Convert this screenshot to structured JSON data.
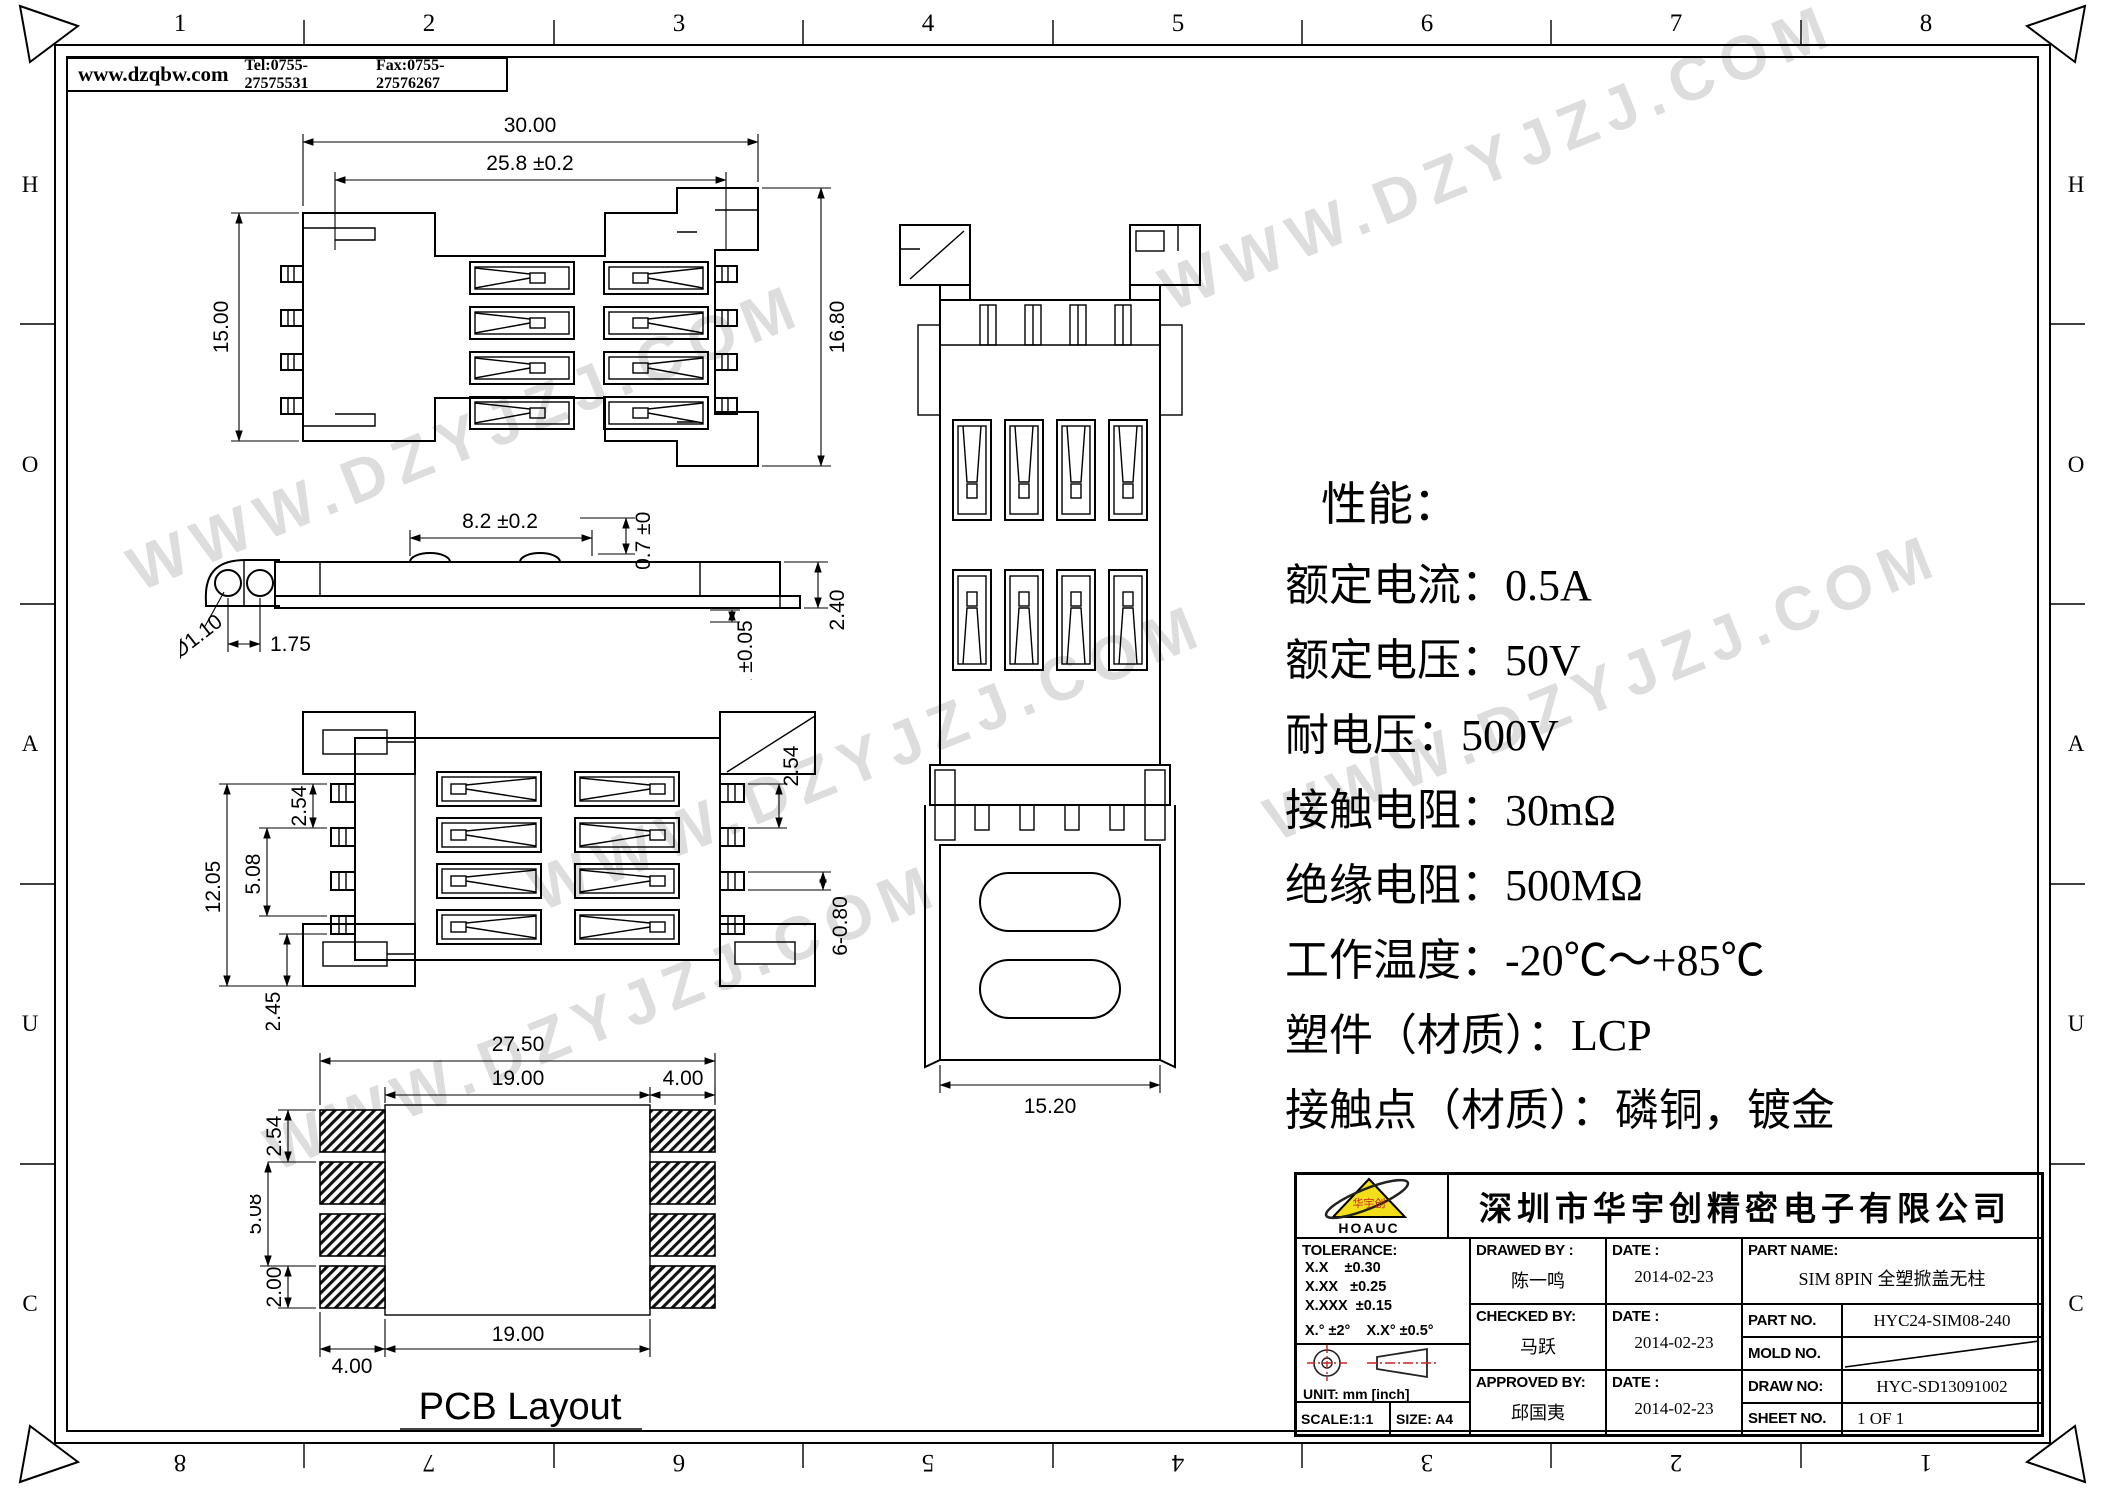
{
  "colors": {
    "line": "#000000",
    "logo_yellow": "#f2df1a",
    "accent_red": "#cc2020",
    "watermark": "#c9c9c9"
  },
  "header": {
    "website": "www.dzqbw.com",
    "tel": "Tel:0755-27575531",
    "fax": "Fax:0755-27576267"
  },
  "frame": {
    "top_numbers": [
      "1",
      "2",
      "3",
      "4",
      "5",
      "6",
      "7",
      "8"
    ],
    "bottom_numbers": [
      "8",
      "7",
      "6",
      "5",
      "4",
      "3",
      "2",
      "1"
    ],
    "left_letters": [
      "H",
      "O",
      "A",
      "U",
      "C"
    ],
    "right_letters": [
      "H",
      "O",
      "A",
      "U",
      "C"
    ]
  },
  "watermark": {
    "text": "WWW.DZYJZJ.COM"
  },
  "views": {
    "top": {
      "dim_overall_width": "30.00",
      "dim_inner_width": "25.8 ±0.2",
      "dim_height_left": "15.00",
      "dim_height_right": "16.80"
    },
    "side": {
      "dim_span": "8.2 ±0.2",
      "dim_tab_height": "0.7 ±0.1",
      "dim_hole": "Ø1.10",
      "dim_pitch": "1.75",
      "dim_gap": "0.1 ±0.05",
      "dim_height": "2.40"
    },
    "bottom": {
      "dim_pitch_small": "2.54",
      "dim_pitch_large": "5.08",
      "dim_height": "12.05",
      "dim_offset": "2.45",
      "dim_pitch_right": "2.54",
      "dim_pin_width": "6-0.80"
    },
    "open": {
      "dim_width": "15.20"
    },
    "pcb": {
      "label": "PCB Layout",
      "dim_outer_width": "27.50",
      "dim_inner_width_top": "19.00",
      "dim_pad_pitch_small": "2.54",
      "dim_pad_pitch_large": "5.08",
      "dim_pad_height": "2.00",
      "dim_pad_width_right": "4.00",
      "dim_pad_width_left": "4.00",
      "dim_inner_width_bottom": "19.00"
    }
  },
  "specs": {
    "title": "性能：",
    "lines": [
      "额定电流：0.5A",
      "额定电压：50V",
      "耐电压：500V",
      "接触电阻：30mΩ",
      "绝缘电阻：500MΩ",
      "工作温度：-20℃～+85℃",
      "塑件（材质）：LCP",
      "接触点（材质）：磷铜，镀金"
    ]
  },
  "title_block": {
    "logo_text": "HOAUC",
    "logo_mark": "华宇创",
    "company": "深圳市华宇创精密电子有限公司",
    "tolerance_label": "TOLERANCE:",
    "tolerance_1": "X.X    ±0.30",
    "tolerance_2": "X.XX   ±0.25",
    "tolerance_3": "X.XXX  ±0.15",
    "tolerance_angle": "X.° ±2°    X.X° ±0.5°",
    "unit_label": "UNIT:  mm  [inch]",
    "scale_label": "SCALE:1:1",
    "size_label": "SIZE:  A4",
    "drawed_by_label": "DRAWED  BY :",
    "drawed_by": "陈一鸣",
    "checked_by_label": "CHECKED  BY:",
    "checked_by": "马跃",
    "approved_by_label": "APPROVED  BY:",
    "approved_by": "邱国夷",
    "date_label": "DATE :",
    "drawed_date": "2014-02-23",
    "checked_date": "2014-02-23",
    "approved_date": "2014-02-23",
    "part_name_label": "PART  NAME:",
    "part_name": "SIM 8PIN 全塑掀盖无柱",
    "part_no_label": "PART  NO.",
    "part_no": "HYC24-SIM08-240",
    "mold_no_label": "MOLD  NO.",
    "draw_no_label": "DRAW  NO:",
    "draw_no": "HYC-SD13091002",
    "sheet_no_label": "SHEET  NO.",
    "sheet_no": "1 OF 1"
  }
}
